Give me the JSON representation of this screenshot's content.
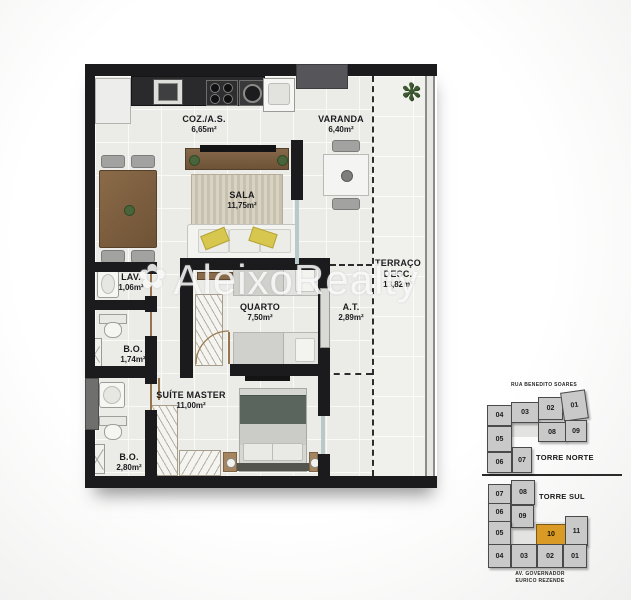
{
  "watermark": {
    "text": "AleixoRealty"
  },
  "plan": {
    "rooms": {
      "kitchen": {
        "name": "COZ./A.S.",
        "area": "6,65m²"
      },
      "varanda": {
        "name": "VARANDA",
        "area": "6,40m²"
      },
      "sala": {
        "name": "SALA",
        "area": "11,75m²"
      },
      "terraco": {
        "line1": "TERRAÇO",
        "line2": "DESC.",
        "area": "13,82m²"
      },
      "lav": {
        "name": "LAV.",
        "area": "1,06m²"
      },
      "quarto": {
        "name": "QUARTO",
        "area": "7,50m²"
      },
      "at": {
        "name": "A.T.",
        "area": "2,89m²"
      },
      "bo1": {
        "name": "B.O.",
        "area": "1,74m²"
      },
      "suite": {
        "name": "SUÍTE MASTER",
        "area": "11,00m²"
      },
      "bo2": {
        "name": "B.O.",
        "area": "2,80m²"
      }
    }
  },
  "keyplan": {
    "torre_norte": {
      "street": "RUA BENEDITO SOARES",
      "title": "TORRE NORTE",
      "units": [
        "04",
        "03",
        "02",
        "01",
        "05",
        "08",
        "09",
        "06",
        "07"
      ]
    },
    "torre_sul": {
      "title": "TORRE SUL",
      "street_line1": "AV. GOVERNADOR",
      "street_line2": "EURICO REZENDE",
      "highlighted_unit": "10",
      "units": [
        "07",
        "08",
        "06",
        "09",
        "05",
        "10",
        "11",
        "04",
        "03",
        "02",
        "01"
      ]
    },
    "colors": {
      "highlight": "#d99b26",
      "block_fill": "#c9c9c9"
    }
  }
}
